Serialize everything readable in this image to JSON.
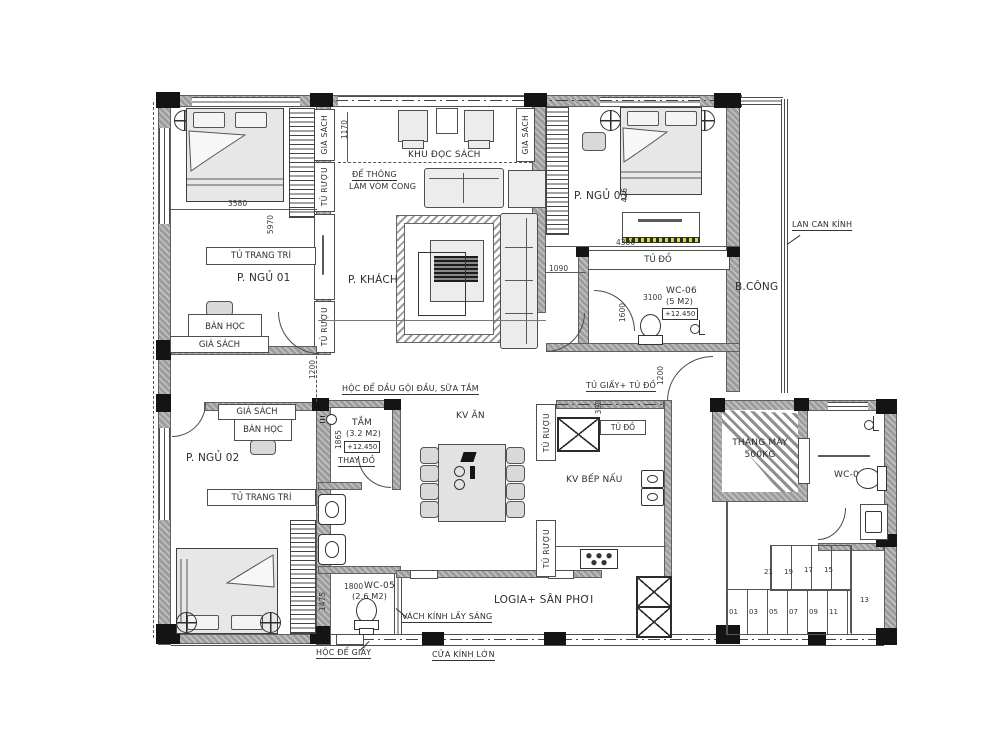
{
  "rooms": {
    "ngu01": "P. NGỦ 01",
    "ngu02": "P. NGỦ 02",
    "ngu03": "P. NGỦ 03",
    "khach": "P. KHÁCH",
    "doc_sach": "KHU ĐỌC SÁCH",
    "kv_an": "KV ĂN",
    "kv_bep": "KV BẾP NẤU",
    "bcong": "B.CÔNG",
    "logia": "LOGIA+ SÂN PHƠI",
    "tam": "TẮM",
    "tam_area": "(3.2 M2)",
    "thay_do": "THAY ĐỒ",
    "wc04": "WC-04",
    "wc05": "WC-05",
    "wc05_area": "(2.6 M2)",
    "wc06": "WC-06",
    "wc06_area": "(5 M2)",
    "thang_may": "THANG MÁY",
    "thang_may_cap": "500KG",
    "level": "+12.450"
  },
  "furniture": {
    "tu_trang_tri": "TỦ TRANG TRÍ",
    "ban_hoc": "BÀN HỌC",
    "gia_sach": "GIÁ SÁCH",
    "tu_ruou": "TỦ RƯỢU",
    "tu_do": "TỦ ĐỒ",
    "tu_giay_tu_do": "TỦ GIẤY+ TỦ ĐỒ"
  },
  "annotations": {
    "de_thong": "ĐỂ THÔNG",
    "lam_vom_cong": "LÀM VÒM CONG",
    "lan_can_kinh": "LAN CAN KÍNH",
    "hoc_de_dau": "HỘC ĐỂ DẦU GỘI ĐẦU, SỮA TẮM",
    "vach_kinh": "VÁCH KÍNH LẤY SÁNG",
    "hoc_de_giay": "HỘC ĐỂ GIẤY",
    "cua_kinh_lon": "CỬA KÍNH LỚN"
  },
  "dims": {
    "w3580": "3580",
    "h5970": "5970",
    "h1170": "1170",
    "h426": "426",
    "w4300": "4300",
    "w1090": "1090",
    "w3100": "3100",
    "h1600": "1600",
    "h1200a": "1200",
    "h1200b": "1200",
    "h1865": "1865",
    "h1475": "1475",
    "w1800": "1800",
    "h390": "390"
  },
  "stairs": {
    "lower": [
      "01",
      "03",
      "05",
      "07",
      "09",
      "11"
    ],
    "upper": [
      "21",
      "19",
      "17",
      "15"
    ],
    "landing": "13"
  },
  "colors": {
    "wall": "#9d9d9d",
    "column": "#141414",
    "furniture_fill": "#ececec",
    "line": "#4a4a4a",
    "accent_yellow": "#d9d943",
    "paper": "#ffffff"
  }
}
